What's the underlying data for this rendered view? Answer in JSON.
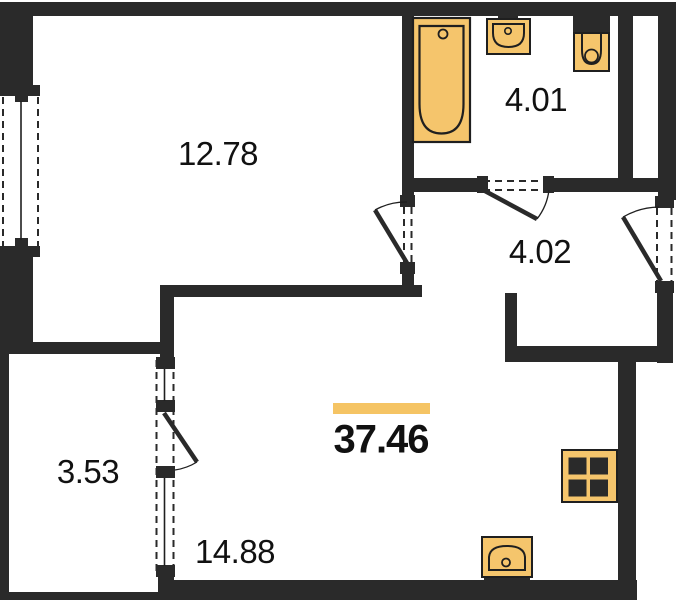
{
  "plan": {
    "title": "apartment-floor-plan",
    "total_area": "37.46",
    "rooms": [
      {
        "name": "living-room",
        "area": "12.78"
      },
      {
        "name": "bathroom",
        "area": "4.01"
      },
      {
        "name": "hallway",
        "area": "4.02"
      },
      {
        "name": "balcony",
        "area": "3.53"
      },
      {
        "name": "kitchen-living-room",
        "area": "14.88"
      }
    ],
    "fixtures": [
      "bathtub-icon",
      "bathroom-sink-icon",
      "toilet-icon",
      "stove-icon",
      "kitchen-sink-icon"
    ],
    "colors": {
      "wall": "#2a2a2a",
      "fixture_fill": "#f5c56c",
      "fixture_stroke": "#1f1f1f",
      "accent_bar": "#f5c464",
      "label_text": "#111111",
      "background": "#ffffff"
    }
  }
}
